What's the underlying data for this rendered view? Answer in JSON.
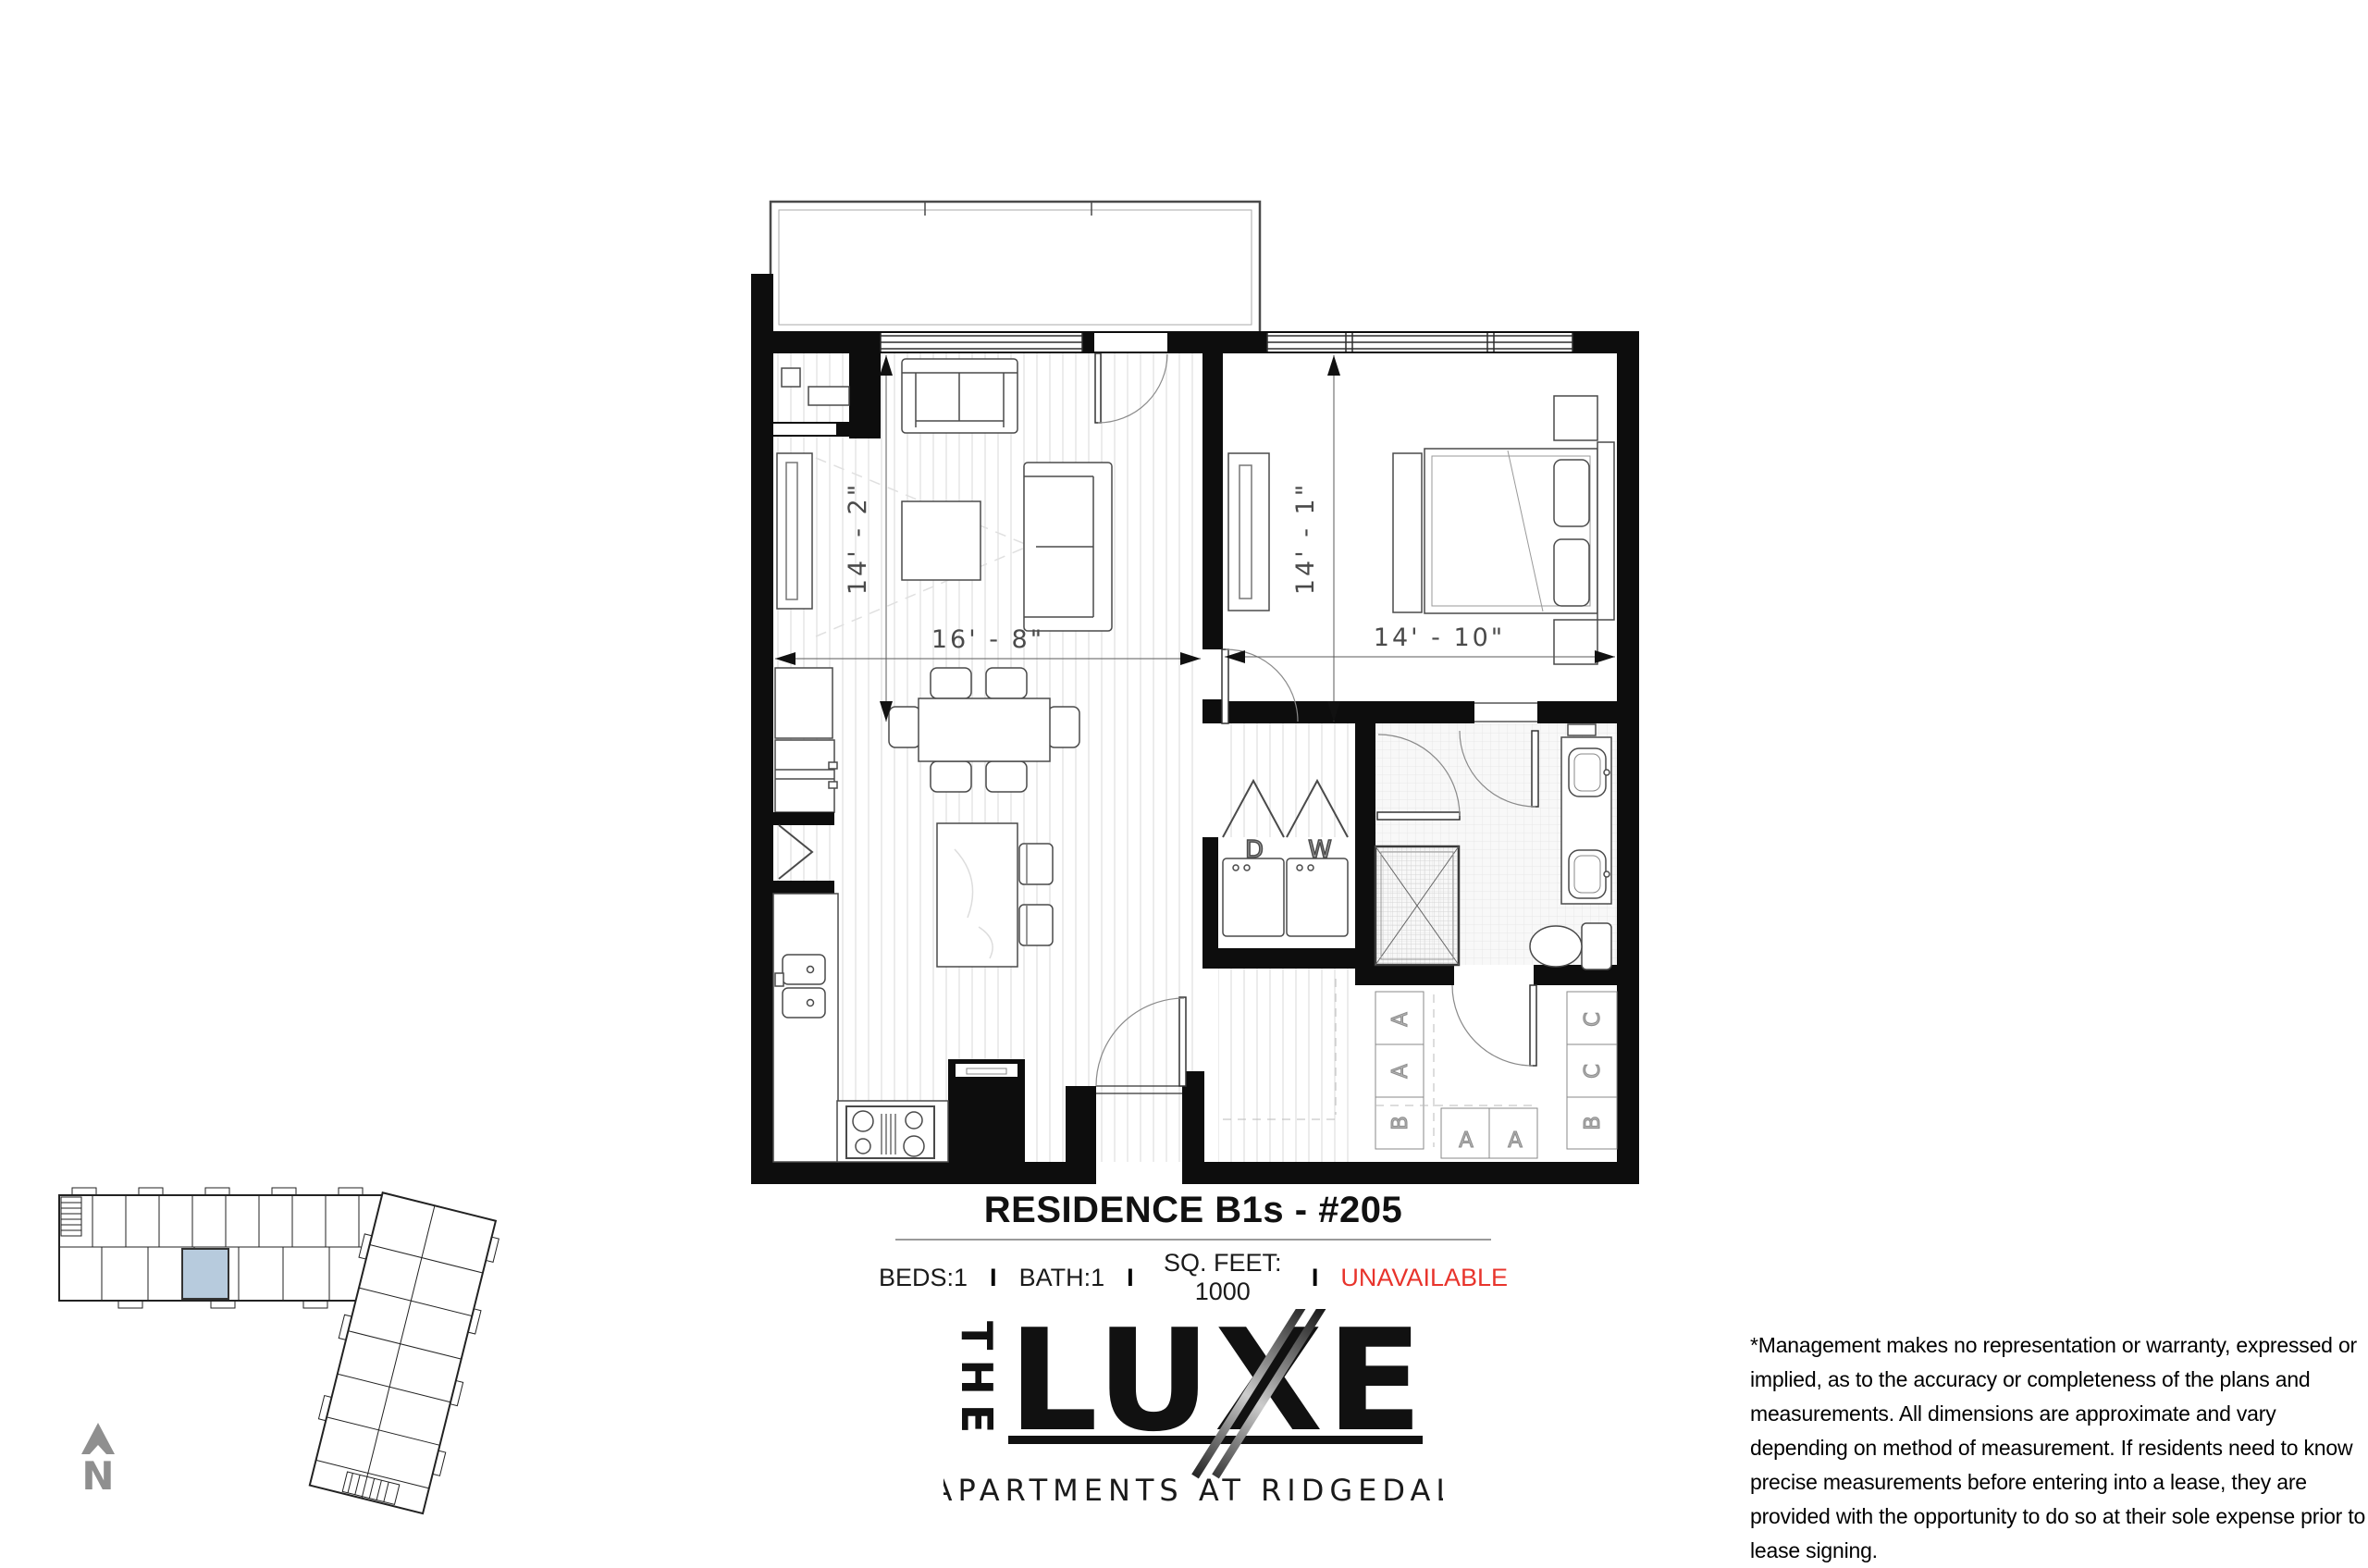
{
  "plan": {
    "title": "RESIDENCE B1s - #205",
    "specs": {
      "beds": "BEDS:1",
      "bath": "BATH:1",
      "sqfeet": "SQ. FEET: 1000",
      "availability": "UNAVAILABLE",
      "divider": "I",
      "availability_color": "#e8342c"
    },
    "dimensions": {
      "living_depth": "14' - 2\"",
      "living_width": "16' - 8\"",
      "bedroom_depth": "14' - 1\"",
      "bedroom_width": "14' - 10\""
    },
    "labels": {
      "dryer": "D",
      "washer": "W",
      "shelf_a": "A",
      "shelf_b": "B",
      "shelf_c": "C"
    }
  },
  "site_plan": {
    "highlight_color": "#b7cbdd",
    "north_label": "N"
  },
  "logo": {
    "the": "THE",
    "name": "LUXE",
    "tagline": "APARTMENTS AT RIDGEDALE"
  },
  "disclaimer": {
    "text": "*Management makes no representation or warranty, expressed or implied, as to the accuracy or completeness of the plans and measurements. All dimensions are approximate and vary depending on method of measurement. If residents need to know precise measurements before entering into a lease, they are provided with the opportunity to do so at their sole expense prior to lease signing."
  }
}
